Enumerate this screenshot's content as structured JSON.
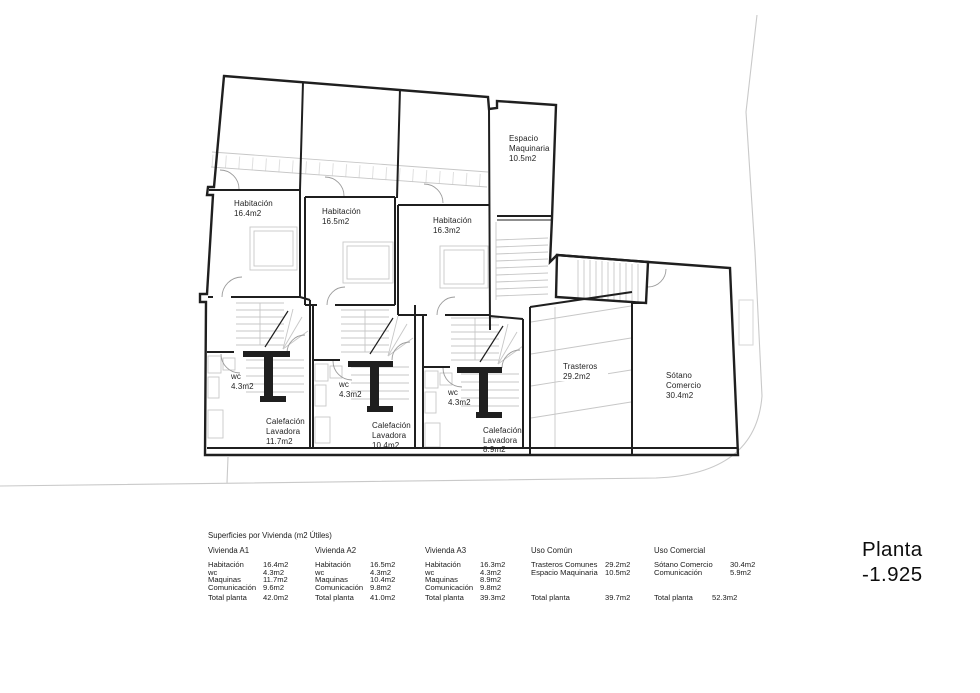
{
  "sheet": {
    "title_line1": "Planta",
    "title_line2": "-1.925"
  },
  "plan": {
    "rooms": {
      "espacio_maquinaria": {
        "line1": "Espacio",
        "line2": "Maquinaria",
        "area": "10.5m2"
      },
      "hab1": {
        "name": "Habitación",
        "area": "16.4m2"
      },
      "hab2": {
        "name": "Habitación",
        "area": "16.5m2"
      },
      "hab3": {
        "name": "Habitación",
        "area": "16.3m2"
      },
      "wc1": {
        "name": "wc",
        "area": "4.3m2"
      },
      "wc2": {
        "name": "wc",
        "area": "4.3m2"
      },
      "wc3": {
        "name": "wc",
        "area": "4.3m2"
      },
      "calefaccion1": {
        "line1": "Calefación",
        "line2": "Lavadora",
        "area": "11.7m2"
      },
      "calefaccion2": {
        "line1": "Calefación",
        "line2": "Lavadora",
        "area": "10.4m2"
      },
      "calefaccion3": {
        "line1": "Calefación",
        "line2": "Lavadora",
        "area": "8.9m2"
      },
      "trasteros": {
        "name": "Trasteros",
        "area": "29.2m2"
      },
      "sotano": {
        "line1": "Sótano",
        "line2": "Comercio",
        "area": "30.4m2"
      }
    }
  },
  "table": {
    "title": "Superficies por Vivienda (m2 Útiles)",
    "columns": [
      {
        "header": "Vivienda A1",
        "rows": [
          [
            "Habitación",
            "16.4m2"
          ],
          [
            "wc",
            "4.3m2"
          ],
          [
            "Maquinas",
            "11.7m2"
          ],
          [
            "Comunicación",
            "9.6m2"
          ]
        ],
        "total_label": "Total planta",
        "total": "42.0m2"
      },
      {
        "header": "Vivienda A2",
        "rows": [
          [
            "Habitación",
            "16.5m2"
          ],
          [
            "wc",
            "4.3m2"
          ],
          [
            "Maquinas",
            "10.4m2"
          ],
          [
            "Comunicación",
            "9.8m2"
          ]
        ],
        "total_label": "Total planta",
        "total": "41.0m2"
      },
      {
        "header": "Vivienda A3",
        "rows": [
          [
            "Habitación",
            "16.3m2"
          ],
          [
            "wc",
            "4.3m2"
          ],
          [
            "Maquinas",
            "8.9m2"
          ],
          [
            "Comunicación",
            "9.8m2"
          ]
        ],
        "total_label": "Total planta",
        "total": "39.3m2"
      },
      {
        "header": "Uso Común",
        "rows": [
          [
            "Trasteros Comunes",
            "29.2m2"
          ],
          [
            "Espacio Maquinaria",
            "10.5m2"
          ]
        ],
        "total_label": "Total planta",
        "total": "39.7m2"
      },
      {
        "header": "Uso Comercial",
        "rows": [
          [
            "Sótano Comercio",
            "30.4m2"
          ],
          [
            "Comunicación",
            "5.9m2"
          ]
        ],
        "total_label": "Total planta",
        "total": "52.3m2"
      }
    ]
  },
  "colors": {
    "wall": "#1f1f1f",
    "detail_gray": "#c7c7c7",
    "boundary_gray": "#c9c9c9"
  }
}
